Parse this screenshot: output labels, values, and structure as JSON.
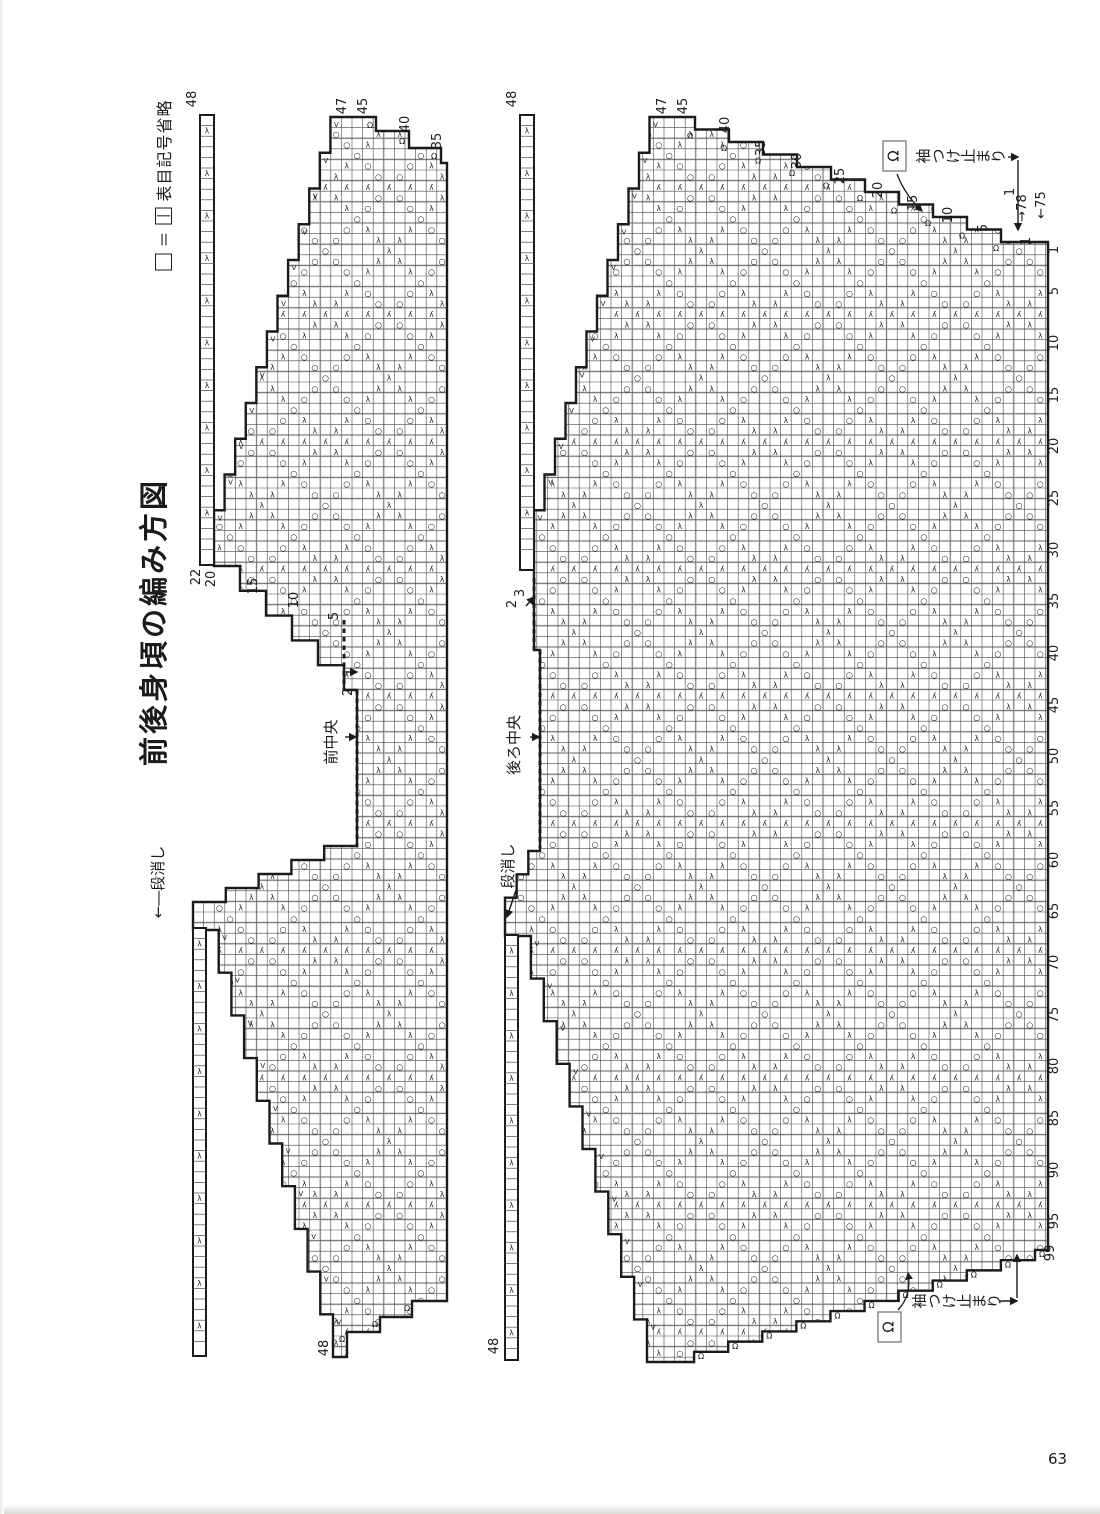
{
  "page": {
    "number": "63",
    "ink": "#1b1b1b",
    "bg": "#ffffff"
  },
  "legend": {
    "empty_square": "□",
    "equals": "＝",
    "boxed_symbol": "|",
    "note": "表目記号省略"
  },
  "title": "前後身頃の編み方図",
  "symbols": {
    "yarnover": "○",
    "decrease": "λ",
    "double_decrease": "ʎ",
    "bindoff": "Ω",
    "increase": "V"
  },
  "charts": [
    {
      "key": "front-body-chart",
      "center_line_label": "前中央",
      "grid_origin": [
        193,
        117
      ],
      "outline": [
        [
          "M",
          341,
          117
        ],
        [
          "L",
          376,
          117
        ],
        [
          "L",
          376,
          131
        ],
        [
          "L",
          409,
          131
        ],
        [
          "L",
          409,
          148
        ],
        [
          "L",
          441,
          148
        ],
        [
          "L",
          441,
          163
        ],
        [
          "L",
          447,
          163
        ],
        [
          "L",
          447,
          1301
        ],
        [
          "L",
          412,
          1301
        ],
        [
          "L",
          412,
          1317
        ],
        [
          "L",
          380,
          1317
        ],
        [
          "L",
          380,
          1332
        ],
        [
          "L",
          347,
          1332
        ],
        [
          "L",
          347,
          1357
        ],
        [
          "L",
          333,
          1357
        ],
        [
          "S",
          206,
          930,
          10,
          "V"
        ],
        [
          "L",
          193,
          930
        ],
        [
          "L",
          193,
          916
        ],
        [
          "S",
          357,
          846,
          5,
          ""
        ],
        [
          "L",
          357,
          690
        ],
        [
          "L",
          344,
          690
        ],
        [
          "S",
          214,
          566,
          5,
          ""
        ],
        [
          "L",
          214,
          546
        ],
        [
          "S",
          341,
          117,
          12,
          "V"
        ]
      ],
      "dashed": [
        [
          344,
          620,
          344,
          690
        ],
        [
          357,
          690,
          357,
          848
        ]
      ],
      "strips": [
        {
          "x": 200,
          "y": 115,
          "w": 14,
          "h": 450
        },
        {
          "x": 193,
          "y": 928,
          "w": 13,
          "h": 428
        }
      ],
      "omega_marks": [
        [
          370,
          128
        ],
        [
          402,
          144
        ],
        [
          434,
          159
        ],
        [
          407,
          1311
        ],
        [
          375,
          1327
        ],
        [
          342,
          1342
        ]
      ],
      "labels": [
        {
          "t": "48",
          "x": 196,
          "y": 99
        },
        {
          "t": "47",
          "x": 346,
          "y": 106
        },
        {
          "t": "45",
          "x": 367,
          "y": 106
        },
        {
          "t": "40",
          "x": 409,
          "y": 124
        },
        {
          "t": "35",
          "x": 441,
          "y": 141
        },
        {
          "t": "22",
          "x": 200,
          "y": 577
        },
        {
          "t": "20",
          "x": 215,
          "y": 579
        },
        {
          "t": "15",
          "x": 257,
          "y": 586
        },
        {
          "t": "10",
          "x": 298,
          "y": 600
        },
        {
          "t": "5",
          "x": 338,
          "y": 616
        },
        {
          "t": "2",
          "x": 352,
          "y": 692
        },
        {
          "t": "48",
          "x": 328,
          "y": 1348
        }
      ],
      "jp_labels": [
        {
          "t": "前中央",
          "x": 336,
          "y": 742,
          "size": 15,
          "kind": "rot"
        },
        {
          "t": "←―段消し",
          "x": 163,
          "y": 882,
          "size": 15,
          "kind": "rot"
        }
      ],
      "arrows": [
        [
          346,
          672,
          357,
          672
        ],
        [
          345,
          737,
          356,
          737
        ]
      ],
      "omega_boxes": [],
      "omega_curves": []
    },
    {
      "key": "back-body-chart",
      "center_line_label": "後ろ中央",
      "grid_origin": [
        505,
        117
      ],
      "outline": [
        [
          "M",
          660,
          117
        ],
        [
          "L",
          695,
          117
        ],
        [
          "S",
          1035,
          242,
          10,
          "O"
        ],
        [
          "L",
          1048,
          242
        ],
        [
          "L",
          1048,
          1250
        ],
        [
          "L",
          1035,
          1250
        ],
        [
          "S",
          660,
          1362,
          11,
          "O"
        ],
        [
          "L",
          647,
          1362
        ],
        [
          "S",
          518,
          936,
          10,
          "V"
        ],
        [
          "L",
          505,
          936
        ],
        [
          "L",
          505,
          921
        ],
        [
          "S",
          540,
          851,
          3,
          ""
        ],
        [
          "L",
          540,
          650
        ],
        [
          "L",
          534,
          650
        ],
        [
          "L",
          534,
          546
        ],
        [
          "S",
          660,
          117,
          12,
          "V"
        ]
      ],
      "dashed": [
        [
          534,
          578,
          534,
          650
        ],
        [
          540,
          650,
          540,
          848
        ]
      ],
      "strips": [
        {
          "x": 520,
          "y": 115,
          "w": 14,
          "h": 455
        },
        {
          "x": 505,
          "y": 935,
          "w": 13,
          "h": 425
        }
      ],
      "omega_marks": [],
      "labels": [
        {
          "t": "48",
          "x": 516,
          "y": 99
        },
        {
          "t": "47",
          "x": 666,
          "y": 106
        },
        {
          "t": "45",
          "x": 687,
          "y": 106
        },
        {
          "t": "40",
          "x": 729,
          "y": 125
        },
        {
          "t": "35",
          "x": 765,
          "y": 148
        },
        {
          "t": "30",
          "x": 801,
          "y": 161
        },
        {
          "t": "25",
          "x": 844,
          "y": 176
        },
        {
          "t": "20",
          "x": 882,
          "y": 190
        },
        {
          "t": "15",
          "x": 917,
          "y": 203
        },
        {
          "t": "10",
          "x": 952,
          "y": 215
        },
        {
          "t": "5",
          "x": 987,
          "y": 228
        },
        {
          "t": "1",
          "x": 1030,
          "y": 241
        },
        {
          "t": "1",
          "x": 1014,
          "y": 192
        },
        {
          "t": "→78",
          "x": 1026,
          "y": 208
        },
        {
          "t": "←75",
          "x": 1045,
          "y": 205
        },
        {
          "t": "1",
          "x": 1058,
          "y": 250
        },
        {
          "t": "5",
          "x": 1058,
          "y": 291
        },
        {
          "t": "10",
          "x": 1058,
          "y": 343
        },
        {
          "t": "15",
          "x": 1058,
          "y": 395
        },
        {
          "t": "20",
          "x": 1058,
          "y": 446
        },
        {
          "t": "25",
          "x": 1058,
          "y": 498
        },
        {
          "t": "30",
          "x": 1058,
          "y": 550
        },
        {
          "t": "35",
          "x": 1058,
          "y": 601
        },
        {
          "t": "40",
          "x": 1058,
          "y": 653
        },
        {
          "t": "45",
          "x": 1058,
          "y": 705
        },
        {
          "t": "50",
          "x": 1058,
          "y": 756
        },
        {
          "t": "55",
          "x": 1058,
          "y": 808
        },
        {
          "t": "60",
          "x": 1058,
          "y": 860
        },
        {
          "t": "65",
          "x": 1058,
          "y": 911
        },
        {
          "t": "70",
          "x": 1058,
          "y": 963
        },
        {
          "t": "75",
          "x": 1058,
          "y": 1015
        },
        {
          "t": "80",
          "x": 1058,
          "y": 1066
        },
        {
          "t": "85",
          "x": 1058,
          "y": 1118
        },
        {
          "t": "90",
          "x": 1058,
          "y": 1170
        },
        {
          "t": "95",
          "x": 1058,
          "y": 1221
        },
        {
          "t": "99",
          "x": 1054,
          "y": 1253
        },
        {
          "t": "3",
          "x": 524,
          "y": 593
        },
        {
          "t": "2",
          "x": 516,
          "y": 604
        },
        {
          "t": "48",
          "x": 498,
          "y": 1346
        }
      ],
      "jp_labels": [
        {
          "t": "後ろ中央",
          "x": 519,
          "y": 745,
          "size": 15,
          "kind": "rot"
        },
        {
          "t": "段消し",
          "x": 513,
          "y": 866,
          "size": 15,
          "kind": "rot"
        },
        {
          "t": "袖つけ止まり",
          "x": 966,
          "y": 156,
          "size": 15,
          "kind": "hrot"
        },
        {
          "t": "袖つけ止まり",
          "x": 962,
          "y": 1301,
          "size": 15,
          "kind": "hrot"
        }
      ],
      "arrows": [
        [
          530,
          737,
          539,
          737
        ],
        [
          526,
          606,
          534,
          597
        ],
        [
          516,
          890,
          507,
          917
        ],
        [
          1008,
          157,
          1018,
          157
        ],
        [
          1018,
          160,
          1018,
          230
        ],
        [
          1000,
          1301,
          1017,
          1301
        ],
        [
          1017,
          1298,
          1017,
          1255
        ]
      ],
      "omega_boxes": [
        {
          "x": 883,
          "y": 141,
          "w": 23,
          "h": 30
        },
        {
          "x": 878,
          "y": 1312,
          "w": 23,
          "h": 30
        }
      ],
      "omega_curves": [
        [
          897,
          174,
          905,
          195,
          922,
          211
        ],
        [
          898,
          1310,
          912,
          1295,
          908,
          1273
        ]
      ]
    }
  ]
}
